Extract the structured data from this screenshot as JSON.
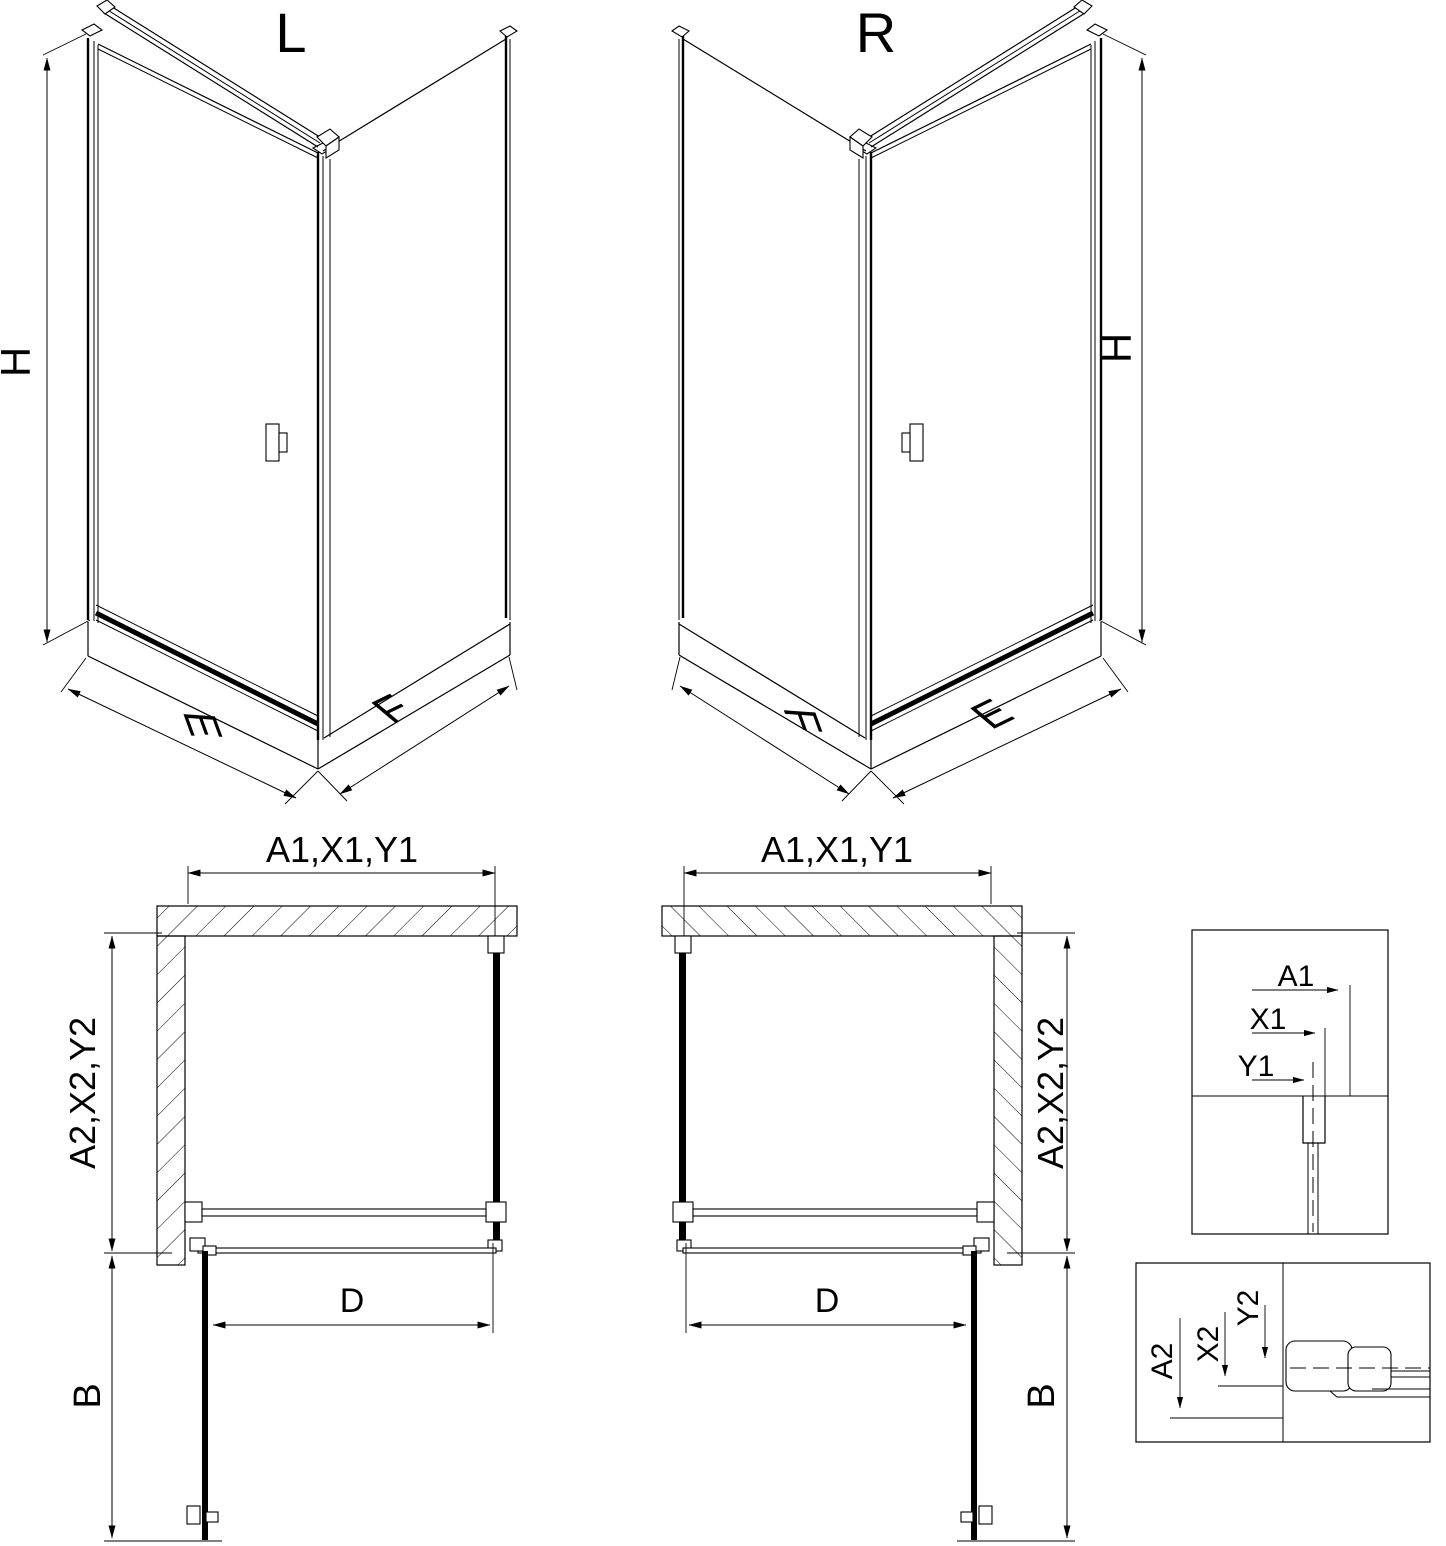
{
  "figure": {
    "iso_left": {
      "title": "L",
      "height": "H",
      "front_width": "E",
      "side_width": "F"
    },
    "iso_right": {
      "title": "R",
      "height": "H",
      "front_width": "E",
      "side_width": "F"
    },
    "plan_left": {
      "top_width": "A1,X1,Y1",
      "side_depth": "A2,X2,Y2",
      "door_width": "D",
      "door_swing": "B"
    },
    "plan_right": {
      "top_width": "A1,X1,Y1",
      "side_depth": "A2,X2,Y2",
      "door_width": "D",
      "door_swing": "B"
    },
    "detail_top": {
      "dim_a": "A1",
      "dim_x": "X1",
      "dim_y": "Y1"
    },
    "detail_bottom": {
      "dim_a": "A2",
      "dim_x": "X2",
      "dim_y": "Y2"
    },
    "colors": {
      "line": "#000000",
      "background": "#ffffff"
    }
  }
}
